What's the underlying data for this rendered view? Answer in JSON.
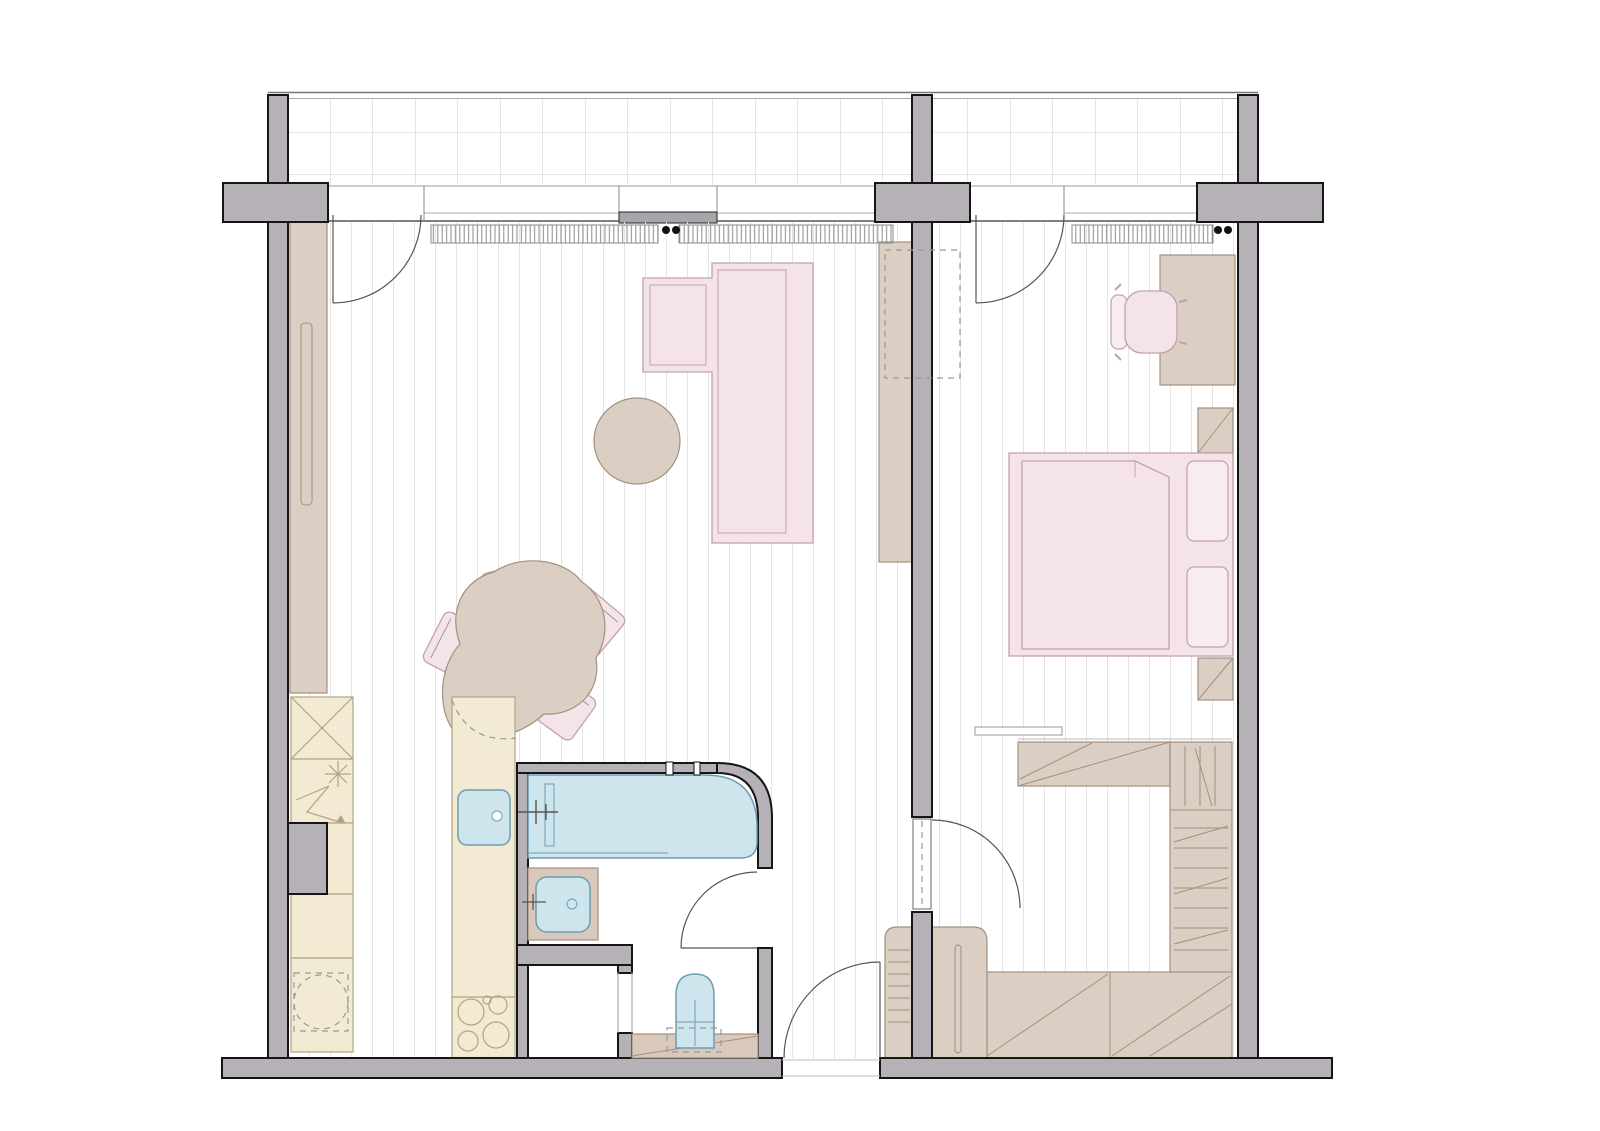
{
  "title": "",
  "colors": {
    "wall": "#b5b1b6",
    "ink": "#161616",
    "cream": "#f2ead3",
    "cream_stroke": "#b1a483",
    "taupe": "#dbcec3",
    "taupe_stroke": "#a5907e",
    "pink": "#f4e3e8",
    "pink_light": "#f7ecf0",
    "pink_stroke": "#c3a0af",
    "blue": "#cfe5ed",
    "blue_stroke": "#6e9cb2",
    "counter": "#d9c9bd",
    "dash": "#999999",
    "arc": "#555555",
    "band_line": "#9a9a9a",
    "floor_line": "#e4e4e4",
    "balcony_line": "#cecece",
    "hatch_line": "#8a8a8a",
    "window_panel": "#a8a5aa",
    "handle_dot": "#111111"
  },
  "plan": {
    "rooms": [
      "balcony",
      "living-room-with-kitchen",
      "bedroom",
      "bathroom",
      "toilet-niche",
      "storage-closet",
      "entry-hall"
    ],
    "furniture": {
      "living": [
        "l-shaped-sofa",
        "round-pouf",
        "dining-table",
        "dining-chairs-x4",
        "tv-sideboard",
        "tall-wardrobe",
        "shoe-rack"
      ],
      "kitchen": [
        "fridge-freezer-column",
        "base-cabinets",
        "washing-machine",
        "island-with-sink",
        "cooktop"
      ],
      "bedroom": [
        "double-bed",
        "pillows-x2",
        "nightstands-x2",
        "desk",
        "desk-chair",
        "walk-in-closet",
        "low-wardrobe",
        "bedside-cabinet",
        "wall-shelf"
      ],
      "bathroom": [
        "bathtub",
        "vanity-sink",
        "toilet"
      ]
    },
    "doors": [
      "balcony-door-living",
      "balcony-door-bedroom",
      "bedroom-door",
      "bathroom-door",
      "entry-door"
    ]
  }
}
